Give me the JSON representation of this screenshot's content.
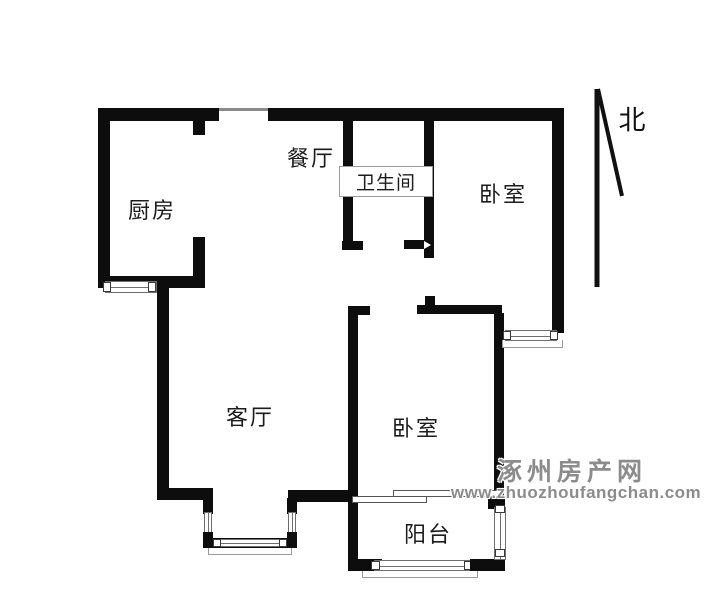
{
  "page": {
    "background": "#ffffff",
    "wall_color": "#0d0d0d",
    "thin_line_color": "#8a8a8a",
    "label_color": "#1c1c1c"
  },
  "rooms": [
    {
      "id": "kitchen",
      "label": "厨房"
    },
    {
      "id": "dining",
      "label": "餐厅"
    },
    {
      "id": "bathroom",
      "label": "卫生间"
    },
    {
      "id": "bedroom-north",
      "label": "卧室"
    },
    {
      "id": "living-room",
      "label": "客厅"
    },
    {
      "id": "bedroom-south",
      "label": "卧室"
    },
    {
      "id": "balcony",
      "label": "阳台"
    }
  ],
  "compass": {
    "label": "北"
  },
  "watermark": {
    "site_name": "涿州房产网",
    "url": "www.zhuozhoufangchan.com",
    "color": "#8c8c8c"
  }
}
